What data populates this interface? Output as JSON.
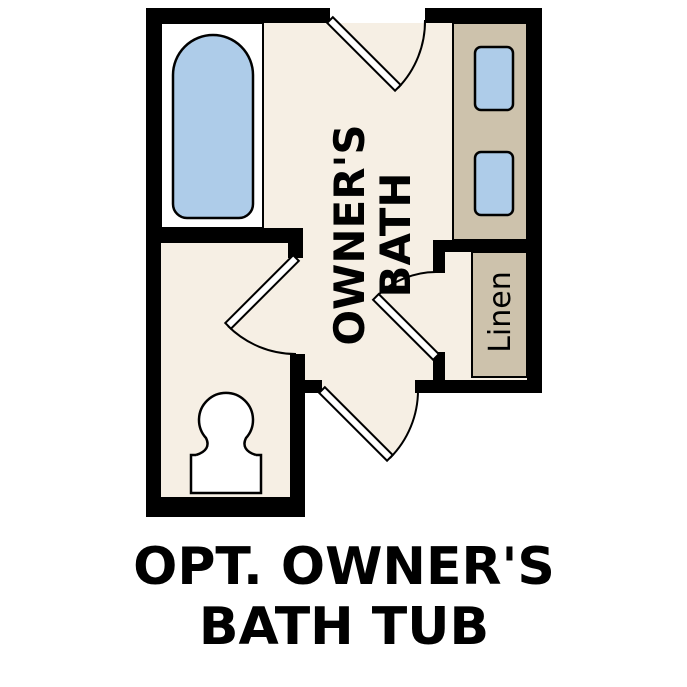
{
  "title": {
    "line1": "OPT. OWNER'S",
    "line2": "BATH TUB"
  },
  "plan": {
    "room_label": {
      "line1": "OWNER'S",
      "line2": "BATH"
    },
    "linen_label": "Linen",
    "colors": {
      "wall_black": "#000000",
      "floor_cream": "#f6efe4",
      "cabinet_tan": "#cdc2ac",
      "water_blue": "#aecce9",
      "fixture_white": "#ffffff"
    }
  }
}
